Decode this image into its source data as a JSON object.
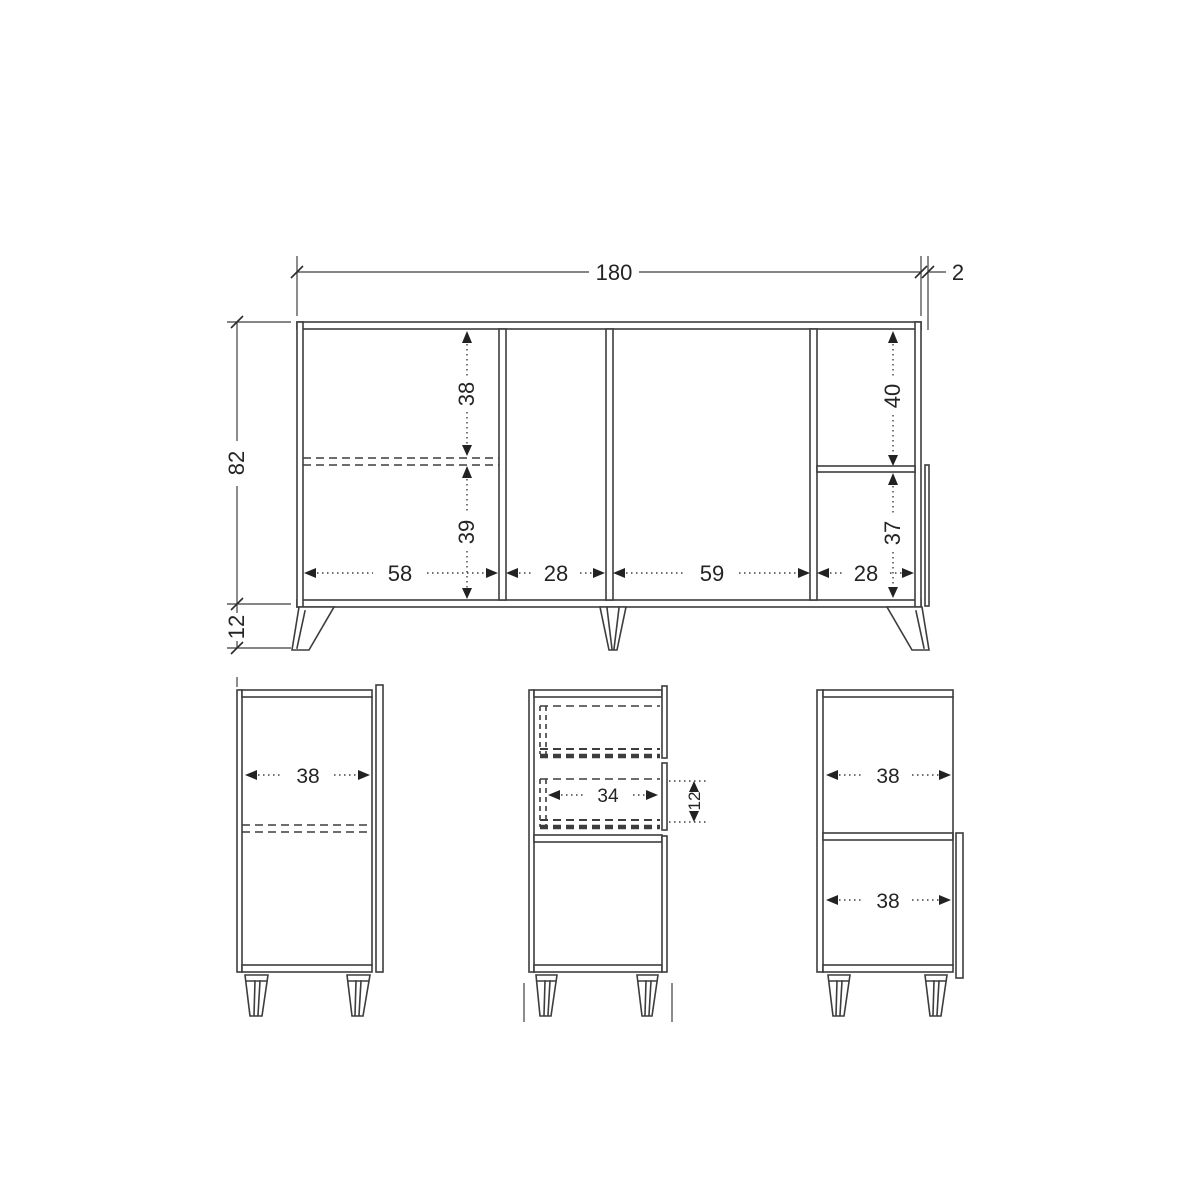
{
  "drawing": {
    "front_view": {
      "overall_width": "180",
      "top_panel_thickness": "2",
      "carcass_height": "82",
      "leg_height": "12",
      "left_bay_upper_height": "38",
      "left_bay_lower_height": "39",
      "right_bay_upper_height": "40",
      "right_bay_lower_height": "37",
      "bay_widths": [
        "58",
        "28",
        "59",
        "28"
      ]
    },
    "side_views": {
      "left": {
        "inner_depth": "38"
      },
      "middle": {
        "drawer_inner_width": "34",
        "drawer_height": "12"
      },
      "right": {
        "upper_inner_depth": "38",
        "lower_inner_depth": "38"
      }
    }
  },
  "colors": {
    "line": "#3d3d3d",
    "text": "#242424",
    "background": "#ffffff"
  }
}
